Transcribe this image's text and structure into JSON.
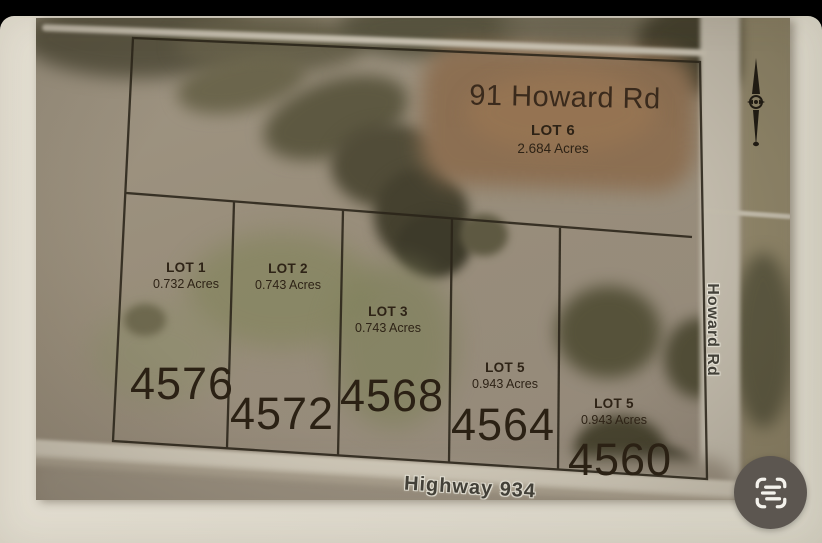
{
  "plat": {
    "title": "91 Howard Rd",
    "lots": [
      {
        "name": "LOT 6",
        "acres": "2.684 Acres"
      },
      {
        "name": "LOT 1",
        "acres": "0.732 Acres"
      },
      {
        "name": "LOT 2",
        "acres": "0.743 Acres"
      },
      {
        "name": "LOT 3",
        "acres": "0.743 Acres"
      },
      {
        "name": "LOT 5",
        "acres": "0.943 Acres"
      },
      {
        "name": "LOT 5",
        "acres": "0.943 Acres"
      }
    ],
    "house_numbers": [
      "4576",
      "4572",
      "4568",
      "4564",
      "4560"
    ],
    "roads": [
      {
        "label": "Highway 934"
      },
      {
        "label": "Howard Rd"
      }
    ],
    "icons": {
      "north_arrow": "north-arrow-icon"
    }
  },
  "controls": {
    "scan_button_icon": "scan-text-icon"
  },
  "colors": {
    "background": "#000000",
    "paper": "#ded9cc",
    "plat_line": "#2a2419",
    "plat_text": "#2e2316",
    "road_label_text": "#44423a",
    "road_label_halo": "#e7e4d8",
    "scan_button_bg": "#5c5650",
    "scan_button_icon": "#f4f2ec"
  }
}
